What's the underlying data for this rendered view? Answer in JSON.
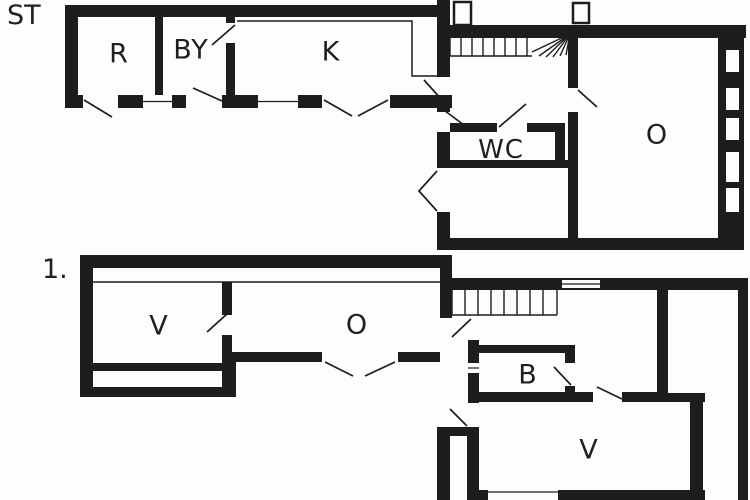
{
  "figure_type": "floor-plan",
  "floors": [
    {
      "short_label": "ST",
      "rooms": [
        {
          "label": "R"
        },
        {
          "label": "BY"
        },
        {
          "label": "K"
        },
        {
          "label": "WC"
        },
        {
          "label": "O"
        }
      ],
      "stairs": true,
      "right_wall_window_count": 5
    },
    {
      "short_label": "1.",
      "rooms": [
        {
          "label": "V"
        },
        {
          "label": "O"
        },
        {
          "label": "B"
        },
        {
          "label": "V"
        }
      ],
      "stairs": true
    }
  ],
  "colors": {
    "wall": "#1d1d1b",
    "background": "#fdfdfb",
    "label_text": "#1f1f1d"
  }
}
